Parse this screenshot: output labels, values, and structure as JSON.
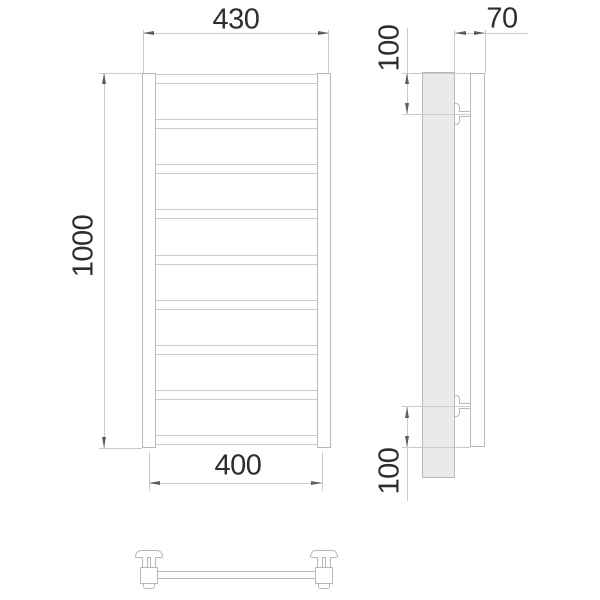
{
  "dimensions": {
    "width_overall": "430",
    "height_overall": "1000",
    "rail_spacing": "400",
    "wall_offset": "70",
    "bracket_top_offset": "100",
    "bracket_bottom_offset": "100"
  },
  "front_view": {
    "rung_count": 9
  },
  "colors": {
    "background": "#ffffff",
    "object_line": "#b5b9b9",
    "thin_line": "#c7cbcb",
    "wall_fill": "#e9ebeb",
    "arrow": "#5a5e5e",
    "text": "#2e2e2e"
  }
}
